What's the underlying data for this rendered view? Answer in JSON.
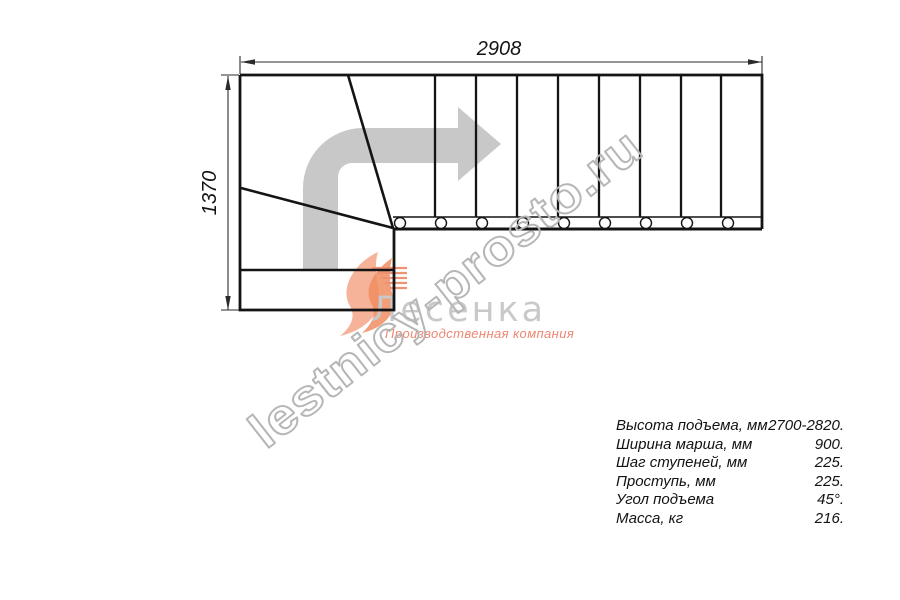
{
  "drawing": {
    "title": "Stair plan, top view",
    "top_dimension": "2908",
    "left_dimension": "1370",
    "upper_flight_treads": 9,
    "winder_treads": 3,
    "stringer_bolt_circles": 9
  },
  "colors": {
    "line": "#141414",
    "direction_arrow": "#c8c8c8",
    "site_watermark": "#b6b6b6",
    "logo_gray": "#c9c9c9",
    "logo_orange": "#ef8050",
    "logo_salmon": "#f6ab8e"
  },
  "watermark": {
    "site": "lestnicy-prosto.ru",
    "logo_text": "Лесенка",
    "logo_subtitle": "Производственная компания"
  },
  "specs": {
    "rows": [
      {
        "label": "Высота подъема, мм",
        "value": "2700-2820."
      },
      {
        "label": "Ширина марша, мм",
        "value": "900."
      },
      {
        "label": "Шаг ступеней, мм",
        "value": "225."
      },
      {
        "label": "Проступь, мм",
        "value": "225."
      },
      {
        "label": "Угол подъема",
        "value": "45°."
      },
      {
        "label": "Масса, кг",
        "value": "216."
      }
    ]
  }
}
